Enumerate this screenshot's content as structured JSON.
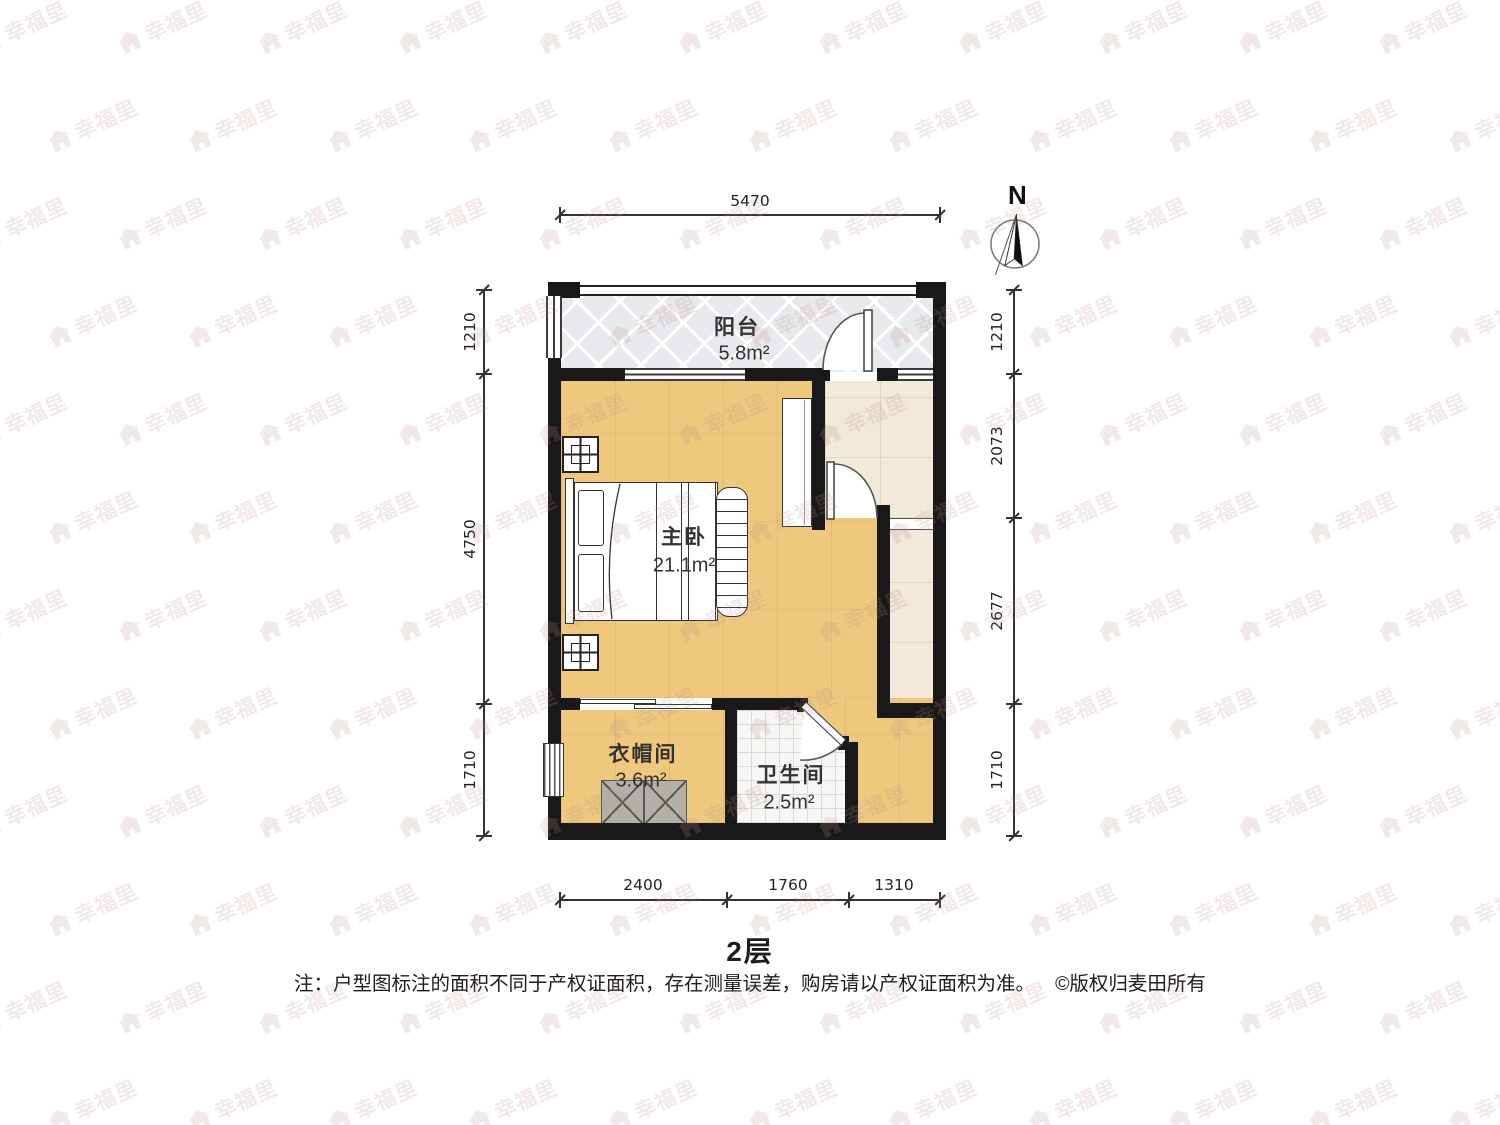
{
  "meta": {
    "title": "2层",
    "note": "注：户型图标注的面积不同于产权证面积，存在测量误差，购房请以产权证面积为准。",
    "copyright": "©版权归麦田所有"
  },
  "compass": {
    "label": "N"
  },
  "watermark": {
    "text": "幸福里"
  },
  "rooms": {
    "balcony": {
      "name": "阳台",
      "area": "5.8m²"
    },
    "bedroom": {
      "name": "主卧",
      "area": "21.1m²"
    },
    "cloakroom": {
      "name": "衣帽间",
      "area": "3.6m²"
    },
    "bathroom": {
      "name": "卫生间",
      "area": "2.5m²"
    }
  },
  "dimensions": {
    "top": [
      {
        "label": "5470"
      }
    ],
    "bottom": [
      {
        "label": "2400"
      },
      {
        "label": "1760"
      },
      {
        "label": "1310"
      }
    ],
    "left": [
      {
        "label": "1210"
      },
      {
        "label": "4750"
      },
      {
        "label": "1710"
      }
    ],
    "right": [
      {
        "label": "1210"
      },
      {
        "label": "2073"
      },
      {
        "label": "2677"
      },
      {
        "label": "1710"
      }
    ]
  },
  "colors": {
    "wall": "#191919",
    "wood_floor": "#efc87e",
    "balcony_tile": "#e8e9ec",
    "hall_tile": "#f1e9d9",
    "bath_tile": "#f6f6f4",
    "wardrobe_gray": "#b3afa9",
    "dimension_line": "#333333",
    "watermark": "#b78b8b"
  }
}
